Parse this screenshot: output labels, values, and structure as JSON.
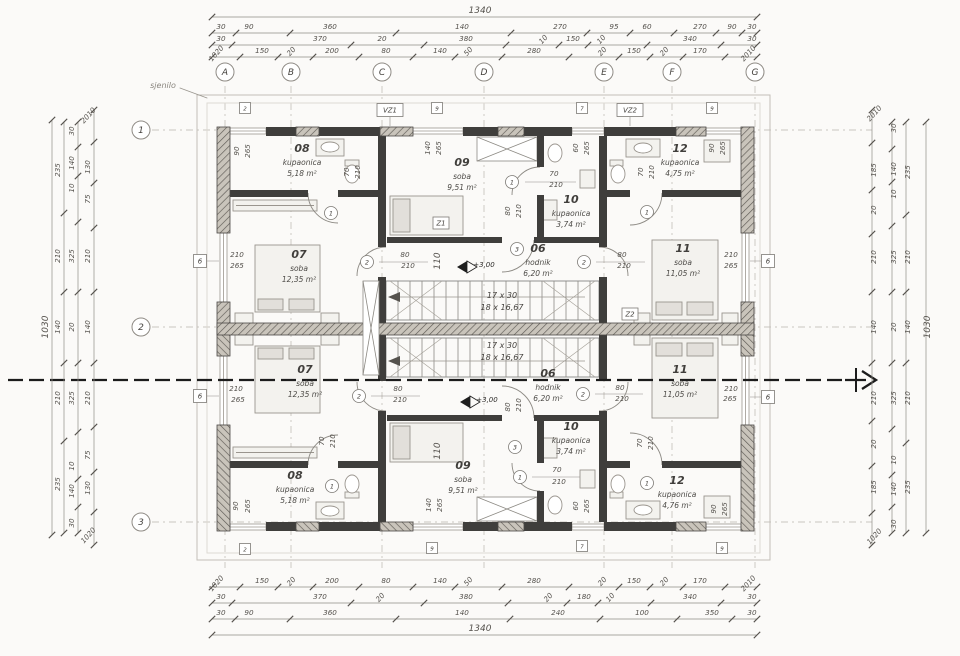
{
  "meta": {
    "sjenilo": "sjenilo"
  },
  "grid": {
    "cols": [
      [
        "A",
        225
      ],
      [
        "B",
        291
      ],
      [
        "C",
        382
      ],
      [
        "D",
        484
      ],
      [
        "E",
        604
      ],
      [
        "F",
        672
      ],
      [
        "G",
        755
      ]
    ],
    "rows": [
      [
        "1",
        130
      ],
      [
        "2",
        327
      ],
      [
        "3",
        522
      ]
    ]
  },
  "dim_lines": [
    {
      "o": "h",
      "p": 17,
      "a": 212,
      "b": 757,
      "t": [
        212,
        757
      ]
    },
    {
      "o": "h",
      "p": 33,
      "a": 212,
      "b": 757,
      "t": [
        212,
        236,
        290,
        396,
        511,
        587,
        630,
        674,
        716,
        742,
        757
      ]
    },
    {
      "o": "h",
      "p": 45,
      "a": 212,
      "b": 757,
      "t": [
        212,
        232,
        351,
        424,
        506,
        559,
        588,
        647,
        721,
        757
      ]
    },
    {
      "o": "h",
      "p": 57,
      "a": 212,
      "b": 757,
      "t": [
        212,
        240,
        278,
        313,
        359,
        413,
        455,
        502,
        569,
        619,
        650,
        683,
        725,
        757
      ]
    },
    {
      "o": "h",
      "p": 587,
      "a": 212,
      "b": 757,
      "t": [
        212,
        240,
        278,
        313,
        359,
        413,
        455,
        502,
        569,
        619,
        650,
        683,
        725,
        757
      ]
    },
    {
      "o": "h",
      "p": 603,
      "a": 212,
      "b": 757,
      "t": [
        212,
        232,
        351,
        424,
        508,
        567,
        598,
        651,
        721,
        757
      ]
    },
    {
      "o": "h",
      "p": 619,
      "a": 212,
      "b": 757,
      "t": [
        212,
        235,
        290,
        396,
        510,
        600,
        677,
        732,
        757
      ]
    },
    {
      "o": "h",
      "p": 635,
      "a": 212,
      "b": 757,
      "t": [
        212,
        757
      ]
    },
    {
      "o": "v",
      "p": 52,
      "a": 120,
      "b": 535,
      "t": [
        120,
        535
      ]
    },
    {
      "o": "v",
      "p": 64,
      "a": 122,
      "b": 533,
      "t": [
        122,
        213,
        292,
        363,
        441,
        533
      ]
    },
    {
      "o": "v",
      "p": 78,
      "a": 122,
      "b": 533,
      "t": [
        122,
        147,
        176,
        222,
        292,
        363,
        432,
        479,
        507,
        533
      ]
    },
    {
      "o": "v",
      "p": 94,
      "a": 110,
      "b": 545,
      "t": [
        110,
        142,
        183,
        228,
        292,
        363,
        427,
        472,
        512,
        545
      ]
    },
    {
      "o": "v",
      "p": 872,
      "a": 110,
      "b": 545,
      "t": [
        110,
        143,
        190,
        234,
        292,
        363,
        421,
        466,
        513,
        545
      ]
    },
    {
      "o": "v",
      "p": 892,
      "a": 122,
      "b": 533,
      "t": [
        122,
        149,
        182,
        226,
        292,
        363,
        429,
        475,
        507,
        533
      ]
    },
    {
      "o": "v",
      "p": 906,
      "a": 122,
      "b": 533,
      "t": [
        122,
        215,
        292,
        363,
        443,
        533
      ]
    },
    {
      "o": "v",
      "p": 926,
      "a": 122,
      "b": 533,
      "t": [
        122,
        533
      ]
    }
  ],
  "dim_labels": [
    [
      "1340",
      480,
      13,
      0,
      9
    ],
    [
      "30",
      221,
      29
    ],
    [
      "90",
      249,
      29
    ],
    [
      "360",
      330,
      29
    ],
    [
      "140",
      462,
      29
    ],
    [
      "270",
      560,
      29
    ],
    [
      "95",
      614,
      29
    ],
    [
      "60",
      647,
      29
    ],
    [
      "270",
      700,
      29
    ],
    [
      "90",
      732,
      29
    ],
    [
      "30",
      752,
      29
    ],
    [
      "30",
      221,
      41
    ],
    [
      "370",
      320,
      41
    ],
    [
      "20",
      382,
      41
    ],
    [
      "380",
      466,
      41
    ],
    [
      "10",
      545,
      41,
      2
    ],
    [
      "150",
      573,
      41
    ],
    [
      "10",
      603,
      41,
      2
    ],
    [
      "340",
      690,
      41
    ],
    [
      "30",
      752,
      41
    ],
    [
      "1020",
      218,
      55,
      2
    ],
    [
      "150",
      262,
      53
    ],
    [
      "20",
      293,
      53,
      2
    ],
    [
      "200",
      332,
      53
    ],
    [
      "80",
      386,
      53
    ],
    [
      "140",
      440,
      53
    ],
    [
      "50",
      470,
      53,
      2
    ],
    [
      "280",
      534,
      53
    ],
    [
      "20",
      604,
      53,
      2
    ],
    [
      "150",
      634,
      53
    ],
    [
      "20",
      666,
      53,
      2
    ],
    [
      "170",
      700,
      53
    ],
    [
      "2010",
      750,
      55,
      2
    ],
    [
      "1020",
      218,
      585,
      2
    ],
    [
      "150",
      262,
      583
    ],
    [
      "20",
      293,
      583,
      2
    ],
    [
      "200",
      332,
      583
    ],
    [
      "80",
      386,
      583
    ],
    [
      "140",
      440,
      583
    ],
    [
      "50",
      470,
      583,
      2
    ],
    [
      "280",
      534,
      583
    ],
    [
      "20",
      604,
      583,
      2
    ],
    [
      "150",
      634,
      583
    ],
    [
      "20",
      666,
      583,
      2
    ],
    [
      "170",
      700,
      583
    ],
    [
      "2010",
      750,
      585,
      2
    ],
    [
      "30",
      221,
      599
    ],
    [
      "370",
      320,
      599
    ],
    [
      "20",
      382,
      599,
      2
    ],
    [
      "380",
      466,
      599
    ],
    [
      "20",
      550,
      599,
      2
    ],
    [
      "180",
      584,
      599
    ],
    [
      "10",
      612,
      599,
      2
    ],
    [
      "340",
      690,
      599
    ],
    [
      "30",
      752,
      599
    ],
    [
      "30",
      221,
      615
    ],
    [
      "90",
      249,
      615
    ],
    [
      "360",
      330,
      615
    ],
    [
      "140",
      462,
      615
    ],
    [
      "240",
      558,
      615
    ],
    [
      "100",
      642,
      615
    ],
    [
      "350",
      712,
      615
    ],
    [
      "30",
      752,
      615
    ],
    [
      "1340",
      480,
      631,
      0,
      9
    ],
    [
      "1030",
      48,
      327,
      1,
      9
    ],
    [
      "235",
      60,
      170,
      1
    ],
    [
      "210",
      60,
      256,
      1
    ],
    [
      "140",
      60,
      327,
      1
    ],
    [
      "210",
      60,
      398,
      1
    ],
    [
      "235",
      60,
      484,
      1
    ],
    [
      "30",
      74,
      131,
      1
    ],
    [
      "140",
      74,
      163,
      1
    ],
    [
      "10",
      74,
      188,
      1
    ],
    [
      "325",
      74,
      256,
      1
    ],
    [
      "20",
      74,
      327,
      1
    ],
    [
      "325",
      74,
      398,
      1
    ],
    [
      "10",
      74,
      466,
      1
    ],
    [
      "140",
      74,
      491,
      1
    ],
    [
      "30",
      74,
      523,
      1
    ],
    [
      "2010",
      90,
      117,
      2
    ],
    [
      "130",
      90,
      167,
      1
    ],
    [
      "75",
      90,
      199,
      1
    ],
    [
      "210",
      90,
      256,
      1
    ],
    [
      "140",
      90,
      327,
      1
    ],
    [
      "210",
      90,
      398,
      1
    ],
    [
      "75",
      90,
      455,
      1
    ],
    [
      "130",
      90,
      488,
      1
    ],
    [
      "1020",
      90,
      537,
      2
    ],
    [
      "2010",
      876,
      115,
      2
    ],
    [
      "185",
      876,
      170,
      1
    ],
    [
      "20",
      876,
      210,
      1
    ],
    [
      "210",
      876,
      257,
      1
    ],
    [
      "140",
      876,
      327,
      1
    ],
    [
      "210",
      876,
      398,
      1
    ],
    [
      "20",
      876,
      444,
      1
    ],
    [
      "185",
      876,
      487,
      1
    ],
    [
      "1020",
      876,
      538,
      2
    ],
    [
      "30",
      896,
      128,
      1
    ],
    [
      "140",
      896,
      169,
      1
    ],
    [
      "10",
      896,
      194,
      1
    ],
    [
      "325",
      896,
      257,
      1
    ],
    [
      "20",
      896,
      327,
      1
    ],
    [
      "325",
      896,
      398,
      1
    ],
    [
      "10",
      896,
      460,
      1
    ],
    [
      "140",
      896,
      489,
      1
    ],
    [
      "30",
      896,
      524,
      1
    ],
    [
      "235",
      910,
      172,
      1
    ],
    [
      "210",
      910,
      257,
      1
    ],
    [
      "140",
      910,
      327,
      1
    ],
    [
      "210",
      910,
      398,
      1
    ],
    [
      "235",
      910,
      487,
      1
    ],
    [
      "1030",
      930,
      327,
      1,
      9
    ],
    [
      "70",
      349,
      172,
      1
    ],
    [
      "210",
      360,
      172,
      1
    ],
    [
      "70",
      643,
      172,
      1
    ],
    [
      "210",
      654,
      172,
      1
    ],
    [
      "60",
      578,
      148,
      1
    ],
    [
      "265",
      589,
      148,
      1
    ],
    [
      "140",
      430,
      148,
      1
    ],
    [
      "265",
      441,
      148,
      1
    ],
    [
      "90",
      239,
      151,
      1
    ],
    [
      "265",
      250,
      151,
      1
    ],
    [
      "90",
      714,
      148,
      1
    ],
    [
      "265",
      725,
      148,
      1
    ],
    [
      "80",
      510,
      211,
      1
    ],
    [
      "210",
      521,
      211,
      1
    ],
    [
      "110",
      440,
      261,
      1,
      9
    ],
    [
      "210",
      237,
      257
    ],
    [
      "265",
      237,
      268
    ],
    [
      "210",
      731,
      257
    ],
    [
      "265",
      731,
      268
    ],
    [
      "70",
      554,
      176
    ],
    [
      "210",
      556,
      187
    ],
    [
      "80",
      622,
      257
    ],
    [
      "210",
      624,
      268
    ],
    [
      "80",
      405,
      257
    ],
    [
      "210",
      408,
      268
    ],
    [
      "70",
      324,
      441,
      1
    ],
    [
      "210",
      335,
      441,
      1
    ],
    [
      "70",
      642,
      443,
      1
    ],
    [
      "210",
      653,
      443,
      1
    ],
    [
      "60",
      578,
      506,
      1
    ],
    [
      "265",
      589,
      506,
      1
    ],
    [
      "140",
      431,
      505,
      1
    ],
    [
      "265",
      442,
      505,
      1
    ],
    [
      "90",
      238,
      506,
      1
    ],
    [
      "265",
      250,
      506,
      1
    ],
    [
      "90",
      716,
      509,
      1
    ],
    [
      "265",
      727,
      509,
      1
    ],
    [
      "80",
      510,
      407,
      1
    ],
    [
      "210",
      521,
      405,
      1
    ],
    [
      "110",
      440,
      451,
      1,
      9
    ],
    [
      "210",
      236,
      391
    ],
    [
      "265",
      238,
      402
    ],
    [
      "210",
      731,
      391
    ],
    [
      "265",
      730,
      401
    ],
    [
      "70",
      557,
      472
    ],
    [
      "210",
      559,
      484
    ],
    [
      "80",
      620,
      390
    ],
    [
      "210",
      622,
      401
    ],
    [
      "80",
      398,
      391
    ],
    [
      "210",
      400,
      402
    ]
  ],
  "rooms": [
    {
      "num": "08",
      "name": "kupaonica",
      "area": "5,18 m²",
      "x": 302,
      "y": 152
    },
    {
      "num": "09",
      "name": "soba",
      "area": "9,51 m²",
      "x": 462,
      "y": 166
    },
    {
      "num": "12",
      "name": "kupaonica",
      "area": "4,75 m²",
      "x": 680,
      "y": 152
    },
    {
      "num": "10",
      "name": "kupaonica",
      "area": "3,74 m²",
      "x": 571,
      "y": 203
    },
    {
      "num": "07",
      "name": "soba",
      "area": "12,35 m²",
      "x": 299,
      "y": 258
    },
    {
      "num": "06",
      "name": "hodnik",
      "area": "6,20 m²",
      "x": 538,
      "y": 252
    },
    {
      "num": "11",
      "name": "soba",
      "area": "11,05 m²",
      "x": 683,
      "y": 252
    },
    {
      "num": "07",
      "name": "soba",
      "area": "12,35 m²",
      "x": 305,
      "y": 373
    },
    {
      "num": "06",
      "name": "hodnik",
      "area": "6,20 m²",
      "x": 548,
      "y": 377
    },
    {
      "num": "11",
      "name": "soba",
      "area": "11,05 m²",
      "x": 680,
      "y": 373
    },
    {
      "num": "10",
      "name": "kupaonica",
      "area": "3,74 m²",
      "x": 571,
      "y": 430
    },
    {
      "num": "08",
      "name": "kupaonica",
      "area": "5,18 m²",
      "x": 295,
      "y": 479
    },
    {
      "num": "09",
      "name": "soba",
      "area": "9,51 m²",
      "x": 463,
      "y": 469
    },
    {
      "num": "12",
      "name": "kupaonica",
      "area": "4,76 m²",
      "x": 677,
      "y": 484
    }
  ],
  "stair_labels": [
    [
      "17 x 30",
      502,
      298
    ],
    [
      "18 x 16,67",
      502,
      310
    ],
    [
      "17 x 30",
      502,
      348
    ],
    [
      "18 x 16,67",
      502,
      360
    ]
  ],
  "levels": [
    [
      "+3,00",
      484,
      267
    ],
    [
      "+3,00",
      487,
      402
    ]
  ],
  "tags_boxed": [
    [
      "VZ1",
      390,
      110,
      26,
      13
    ],
    [
      "VZ2",
      630,
      110,
      26,
      13
    ],
    [
      "Z1",
      441,
      223,
      16,
      12
    ],
    [
      "Z2",
      630,
      314,
      16,
      12
    ],
    [
      "6",
      200,
      261,
      13,
      13
    ],
    [
      "6",
      200,
      396,
      13,
      13
    ],
    [
      "6",
      768,
      261,
      13,
      13
    ],
    [
      "6",
      768,
      397,
      13,
      13
    ],
    [
      "2",
      245,
      108,
      11,
      11
    ],
    [
      "9",
      437,
      108,
      11,
      11
    ],
    [
      "7",
      582,
      108,
      11,
      11
    ],
    [
      "9",
      712,
      108,
      11,
      11
    ],
    [
      "2",
      245,
      549,
      11,
      11
    ],
    [
      "9",
      432,
      548,
      11,
      11
    ],
    [
      "7",
      582,
      546,
      11,
      11
    ],
    [
      "9",
      722,
      548,
      11,
      11
    ]
  ],
  "tags_circled": [
    [
      "1",
      512,
      182
    ],
    [
      "2",
      584,
      262
    ],
    [
      "2",
      367,
      262
    ],
    [
      "3",
      517,
      249
    ],
    [
      "1",
      647,
      212
    ],
    [
      "1",
      331,
      213
    ],
    [
      "1",
      520,
      477
    ],
    [
      "2",
      583,
      394
    ],
    [
      "2",
      359,
      396
    ],
    [
      "3",
      515,
      447
    ],
    [
      "1",
      647,
      483
    ],
    [
      "1",
      332,
      486
    ]
  ]
}
